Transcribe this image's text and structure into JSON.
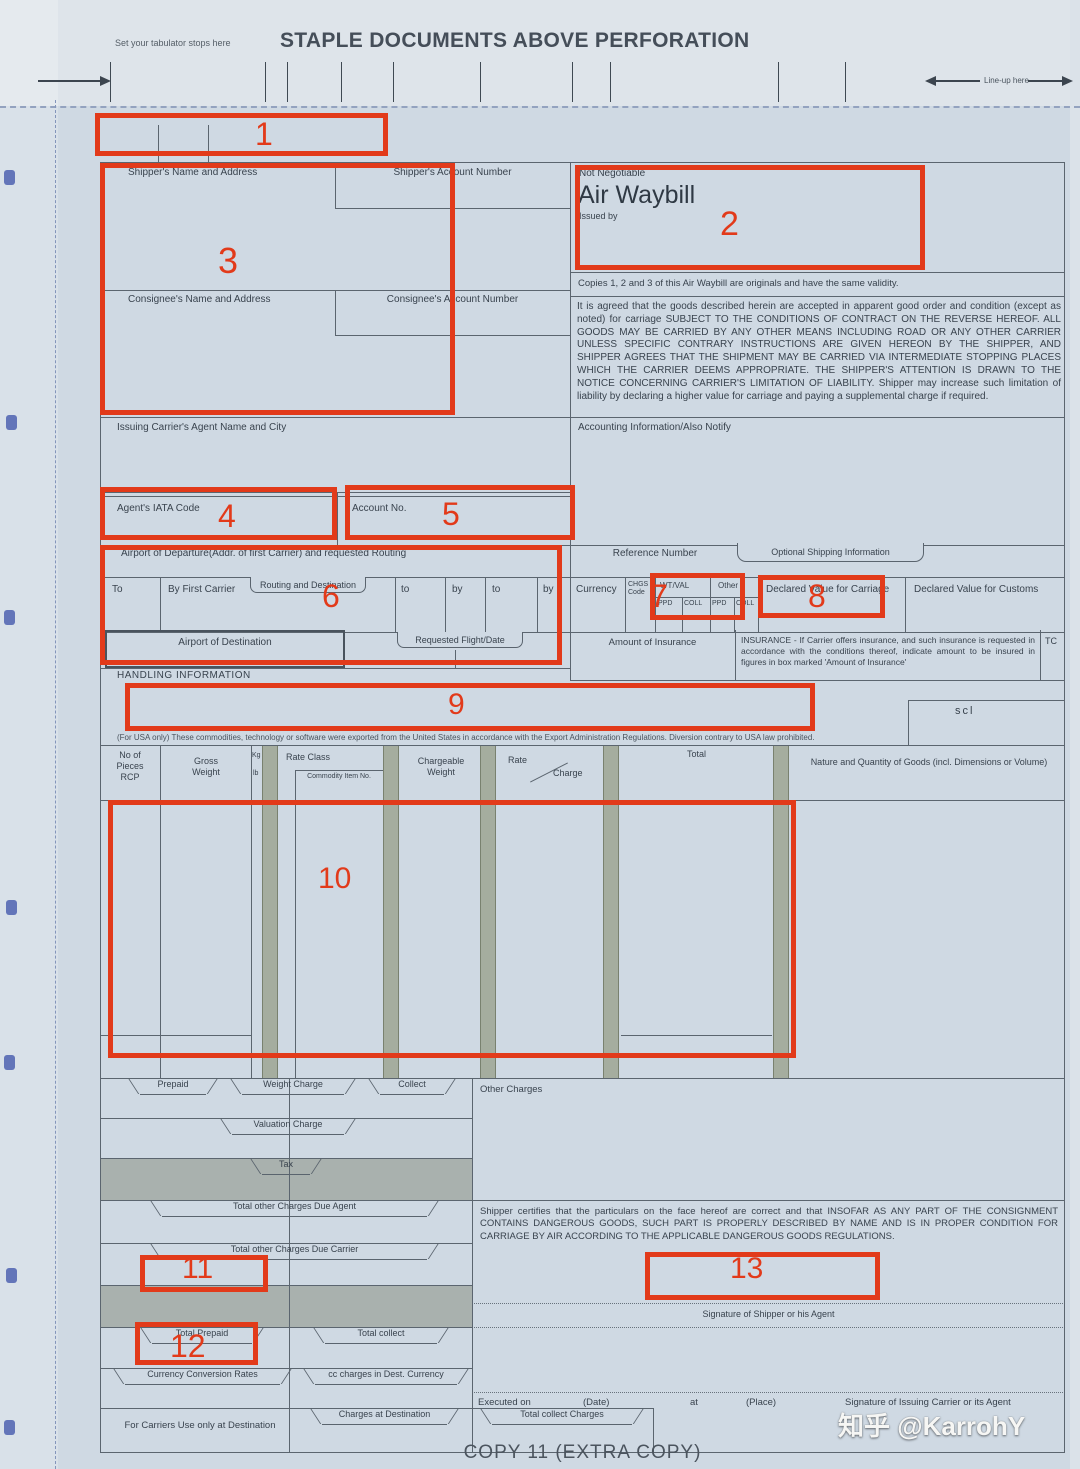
{
  "annotation_color": "#e23a1a",
  "annotations": {
    "labels": [
      "1",
      "2",
      "3",
      "4",
      "5",
      "6",
      "7",
      "8",
      "9",
      "10",
      "11",
      "12",
      "13"
    ]
  },
  "topbar": {
    "tabulator_note": "Set your tabulator stops here",
    "title": "STAPLE DOCUMENTS ABOVE PERFORATION",
    "lineup_label": "Line-up here"
  },
  "awb": {
    "not_negotiable": "Not Negotiable",
    "air_waybill": "Air Waybill",
    "issued_by": "Issued by",
    "copies_note": "Copies 1, 2 and 3 of this Air Waybill are originals and have the same validity.",
    "conditions": "It is agreed that the goods described herein are accepted in apparent good order and condition (except as noted) for carriage SUBJECT TO THE CONDITIONS OF CONTRACT ON THE REVERSE HEREOF. ALL GOODS MAY BE CARRIED BY ANY OTHER MEANS INCLUDING ROAD OR ANY OTHER CARRIER UNLESS SPECIFIC CONTRARY INSTRUCTIONS ARE GIVEN HEREON BY THE SHIPPER, AND SHIPPER AGREES THAT THE SHIPMENT MAY BE CARRIED VIA INTERMEDIATE STOPPING PLACES WHICH THE CARRIER DEEMS APPROPRIATE. THE SHIPPER'S ATTENTION IS DRAWN TO THE NOTICE CONCERNING CARRIER'S LIMITATION OF LIABILITY. Shipper may increase such limitation of liability by declaring a higher value for carriage and paying a supplemental charge if required."
  },
  "parties": {
    "shipper_name": "Shipper's Name and Address",
    "shipper_account": "Shipper's Account Number",
    "consignee_name": "Consignee's Name and Address",
    "consignee_account": "Consignee's Account Number",
    "agent_name_city": "Issuing Carrier's Agent Name and City",
    "accounting_info": "Accounting Information/Also Notify"
  },
  "codes": {
    "agent_iata_code": "Agent's IATA Code",
    "account_no": "Account No."
  },
  "routing": {
    "departure_label": "Airport of Departure(Addr. of first Carrier) and requested Routing",
    "reference_number": "Reference Number",
    "optional_shipping": "Optional Shipping Information",
    "to_cap": "To",
    "by_first_carrier": "By First Carrier",
    "routing_and_destination": "Routing and Destination",
    "to": "to",
    "by": "by",
    "airport_of_destination": "Airport of Destination",
    "requested_flight_date": "Requested Flight/Date"
  },
  "charges_header": {
    "currency": "Currency",
    "chgs": "CHGS",
    "code": "Code",
    "wt_val": "WT/VAL",
    "other": "Other",
    "ppd": "PPD",
    "coll": "COLL",
    "declared_value_carriage": "Declared Value for Carriage",
    "declared_value_customs": "Declared Value for Customs",
    "amount_of_insurance": "Amount of Insurance",
    "insurance_note": "INSURANCE - If Carrier offers insurance, and such insurance is requested in accordance with the conditions thereof, indicate amount to be insured in figures in box marked 'Amount of Insurance'",
    "tc": "TC"
  },
  "handling": {
    "label": "HANDLING INFORMATION",
    "sci": "scl",
    "usa_note": "(For USA only) These commodities, technology or software were exported from the United States in accordance with the Export Administration Regulations. Diversion contrary to USA law prohibited."
  },
  "goods_table": {
    "no_of_pieces": "No of Pieces RCP",
    "gross_weight": "Gross Weight",
    "kg": "Kg",
    "lb": "lb",
    "rate_class": "Rate Class",
    "commodity_item_no": "Commodity Item No.",
    "chargeable_weight": "Chargeable Weight",
    "rate": "Rate",
    "charge": "Charge",
    "total": "Total",
    "nature_quantity": "Nature and Quantity of Goods (incl. Dimensions or Volume)"
  },
  "totals": {
    "prepaid": "Prepaid",
    "weight_charge": "Weight Charge",
    "collect": "Collect",
    "other_charges": "Other Charges",
    "valuation_charge": "Valuation Charge",
    "tax": "Tax",
    "due_agent": "Total other Charges Due Agent",
    "due_carrier": "Total other Charges Due Carrier",
    "total_prepaid": "Total Prepaid",
    "total_collect": "Total collect",
    "currency_conversion_rates": "Currency Conversion Rates",
    "cc_charges_dest": "cc charges in Dest. Currency",
    "carriers_use": "For Carriers Use only at Destination",
    "charges_at_destination": "Charges at Destination",
    "total_collect_charges": "Total collect Charges"
  },
  "signature": {
    "certification": "Shipper certifies that the particulars on the face hereof are correct and that INSOFAR AS ANY PART OF THE CONSIGNMENT CONTAINS DANGEROUS GOODS, SUCH PART IS PROPERLY DESCRIBED BY NAME AND IS IN PROPER CONDITION FOR CARRIAGE BY AIR ACCORDING TO THE APPLICABLE DANGEROUS GOODS REGULATIONS.",
    "shipper_sign": "Signature of Shipper or his Agent",
    "executed_on": "Executed on",
    "date": "(Date)",
    "at": "at",
    "place": "(Place)",
    "carrier_sign": "Signature of Issuing Carrier or its Agent"
  },
  "footer": {
    "copy_label": "COPY 11 (EXTRA COPY)",
    "watermark": "知乎 @KarrohY"
  }
}
